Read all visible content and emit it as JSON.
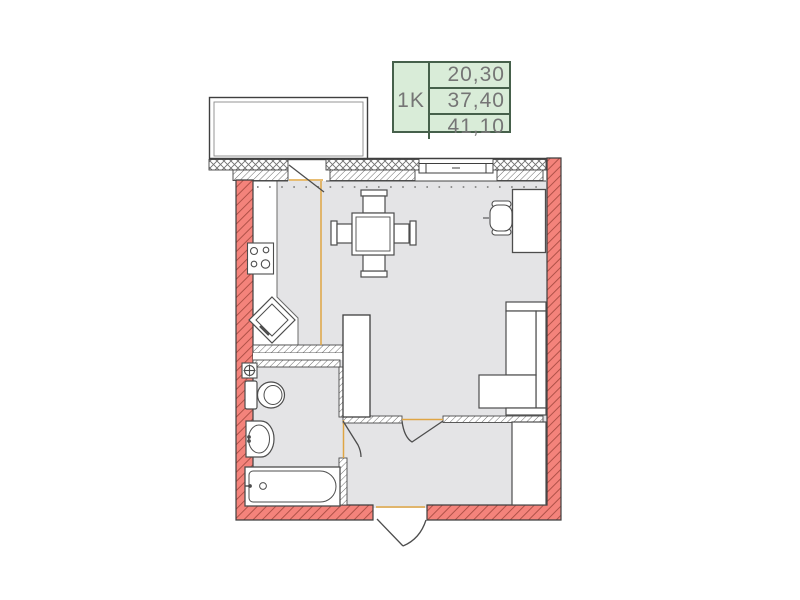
{
  "legend": {
    "unit_type": "1K",
    "rows": [
      "20,30",
      "37,40",
      "41,10"
    ]
  },
  "colors": {
    "wall_fill": "#f4837b",
    "wall_hatch": "#a84c42",
    "floor": "#e4e4e6",
    "accent_orange": "#dfa544",
    "legend_bg": "#d9ecd8",
    "legend_border": "#46604b",
    "legend_text": "#757575"
  }
}
